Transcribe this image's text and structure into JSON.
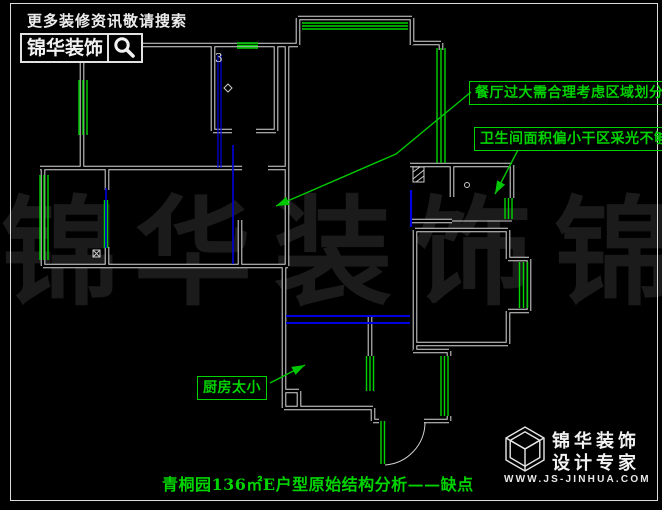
{
  "header": {
    "tagline": "更多装修资讯敬请搜索",
    "search_brand": "锦华装饰",
    "search_icon": "magnifier-icon"
  },
  "annotations": {
    "dining": "餐厅过大需合理考虑区域划分",
    "bathroom": "卫生间面积偏小干区采光不够",
    "kitchen": "厨房太小"
  },
  "caption": "青桐园136㎡E户型原始结构分析——缺点",
  "watermark": {
    "chars": [
      "锦",
      "华",
      "装",
      "饰",
      "锦"
    ]
  },
  "plan": {
    "room_tag": "3"
  },
  "logo": {
    "name_line": "锦华装饰",
    "slogan_line": "设计专家",
    "url": "WWW.JS-JINHUA.COM",
    "cube_icon": "isometric-cube-logo"
  },
  "colors": {
    "background": "#000000",
    "wall": "#d9d9d9",
    "window_green": "#00d400",
    "annotation_green": "#00d400",
    "door_blue": "#0000e0",
    "watermark_gray": "#1b1b1b",
    "text_white": "#f2f2f2"
  }
}
